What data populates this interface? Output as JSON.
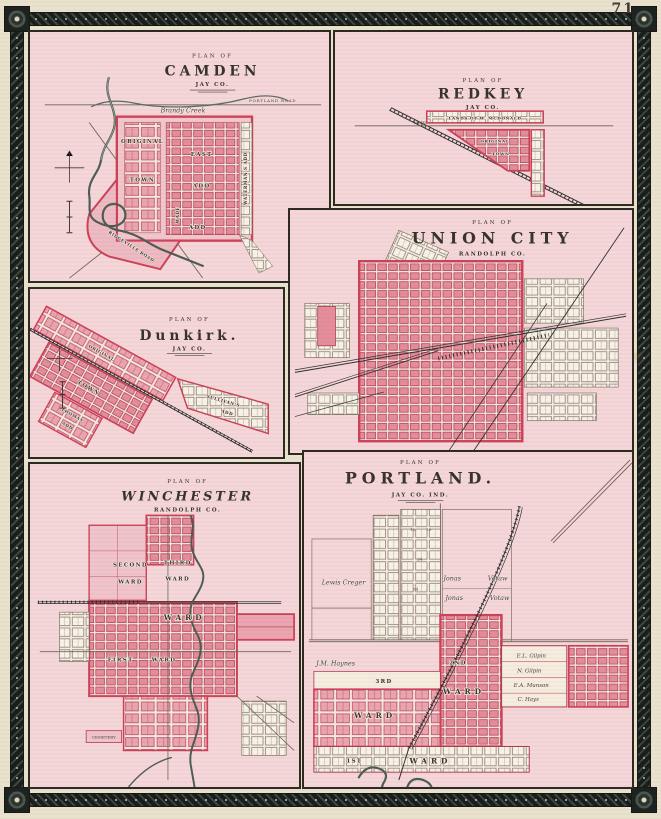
{
  "page": {
    "number": "71"
  },
  "colors": {
    "paper": "#e9e2cd",
    "panel_pink": "#f5d6d9",
    "plat_red": "#cc3f58",
    "block_fill": "#eba3af",
    "ink": "#35302a",
    "border_band": "#28302c",
    "river": "#4c5a52"
  },
  "panels": {
    "camden": {
      "plan_of": "PLAN OF",
      "title": "CAMDEN",
      "subtitle": "JAY CO.",
      "labels": {
        "creek": "Brandy Creek",
        "road_top": "PORTLAND ROAD",
        "original": "ORIGINAL",
        "town": "TOWN",
        "east": "EAST",
        "east_add": "ADD",
        "watermans": "WATERMAN'S ADD",
        "wade": "WADE",
        "wade_add": "ADD",
        "ridgeville": "RIDGEVILLE ROAD"
      }
    },
    "redkey": {
      "plan_of": "PLAN OF",
      "title": "REDKEY",
      "subtitle": "JAY CO.",
      "labels": {
        "lands": "LANDS OF W. MCDONALD",
        "original": "ORIGINAL",
        "town": "TOWN",
        "main": "MAIN"
      }
    },
    "union_city": {
      "plan_of": "PLAN OF",
      "title": "UNION CITY",
      "subtitle": "RANDOLPH CO."
    },
    "dunkirk": {
      "plan_of": "PLAN OF",
      "title": "Dunkirk.",
      "subtitle": "JAY CO.",
      "labels": {
        "original": "ORIGINAL",
        "town": "TOWN",
        "sullivans": "SULLIVAN'S",
        "sullivans_add": "ADD",
        "thomas": "THOMAS",
        "thomas_add": "ADD"
      }
    },
    "winchester": {
      "plan_of": "PLAN OF",
      "title": "WINCHESTER",
      "subtitle": "RANDOLPH CO.",
      "labels": {
        "second": "SECOND",
        "second_ward": "WARD",
        "third": "THIRD",
        "third_ward": "WARD",
        "ward": "WARD",
        "first": "FIRST",
        "first_ward": "WARD",
        "cemetery": "CEMETERY"
      }
    },
    "portland": {
      "plan_of": "PLAN OF",
      "title": "PORTLAND.",
      "subtitle": "JAY CO. IND.",
      "labels": {
        "lewis_creger": "Lewis Creger",
        "jonas_a": "Jonas",
        "votaw_a": "Votaw",
        "jonas_b": "Jonas",
        "votaw_b": "Votaw",
        "jm_haynes": "J.M. Haynes",
        "el_gilpin": "E.L. Gilpin",
        "n_gilpin": "N. Gilpin",
        "ea_munson": "E.A. Munson",
        "c_hays": "C. Hays",
        "ward2_ord": "2ND",
        "ward2": "WARD",
        "ward3_ord": "3RD",
        "ward3": "WARD",
        "ward1_ord": "1ST",
        "ward1": "WARD"
      },
      "lot_numbers": [
        "18",
        "19",
        "34",
        "54"
      ]
    }
  }
}
